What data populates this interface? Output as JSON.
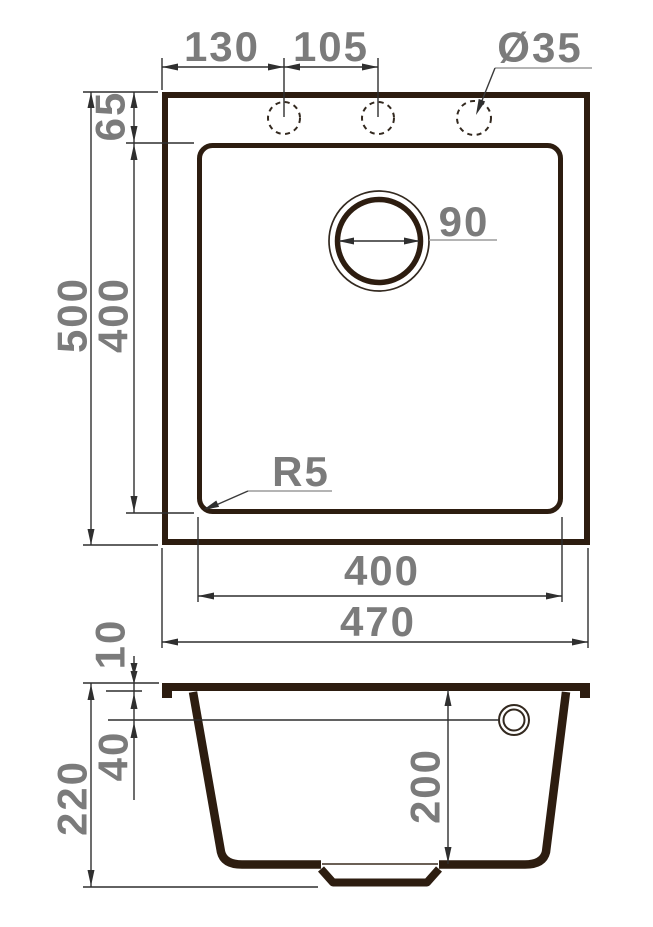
{
  "drawing": {
    "subject": "kitchen sink dimensional drawing",
    "views": {
      "plan": {
        "name": "top view",
        "dims": {
          "faucet_offset_left": "130",
          "faucet_spacing": "105",
          "faucet_hole_diameter": "Ø35",
          "top_edge_to_bowl": "65",
          "overall_depth": "500",
          "bowl_depth": "400",
          "drain_diameter": "90",
          "bowl_corner_radius": "R5",
          "bowl_width": "400",
          "overall_width": "470"
        }
      },
      "section": {
        "name": "front section view",
        "dims": {
          "rim_height": "10",
          "rim_to_overflow": "40",
          "overall_height": "220",
          "bowl_inner_depth": "200"
        }
      }
    },
    "colors": {
      "outline": "#2d1d10",
      "dimension_lines": "#2f2f2f",
      "labels": "#7b7b7b",
      "leader_lines": "#9b9b9b",
      "background": "#ffffff"
    }
  }
}
